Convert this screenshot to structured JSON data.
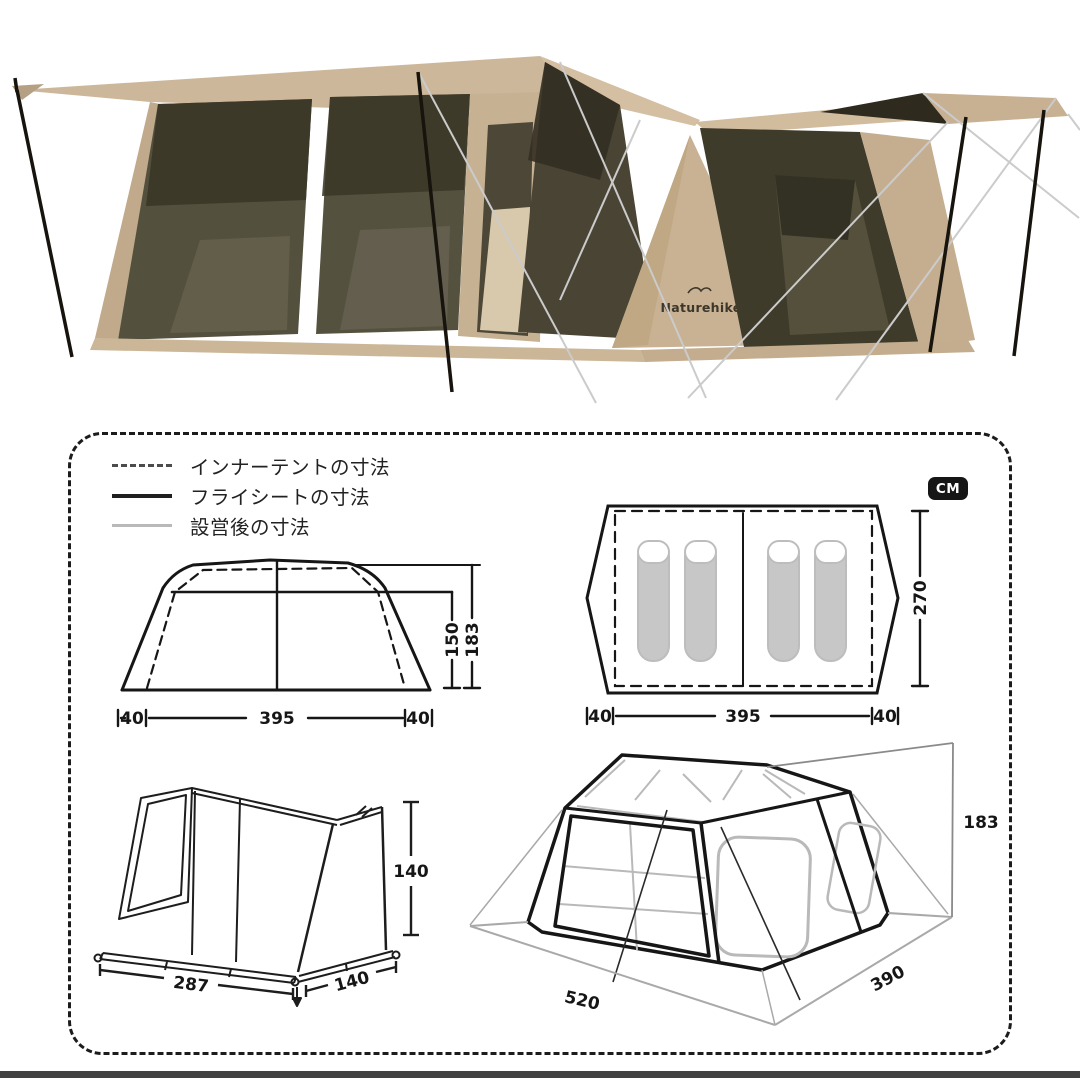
{
  "photo": {
    "brand_logo": "Naturehike",
    "colors": {
      "canvas_tan": "#cdb79b",
      "canvas_dark": "#b6a084",
      "mesh_dark": "#3a3627",
      "mesh_smoke": "#53503e",
      "olive_panel": "#3f3b2b",
      "pole_black": "#17130d",
      "guyline_gray": "#cbcbcb"
    }
  },
  "units_badge": "CM",
  "legend": {
    "items": [
      {
        "label": "インナーテントの寸法",
        "style": "dashed"
      },
      {
        "label": "フライシートの寸法",
        "style": "solid-dark"
      },
      {
        "label": "設営後の寸法",
        "style": "solid-gray"
      }
    ]
  },
  "diagrams": {
    "front_view": {
      "inner_height": "150",
      "outer_height": "183",
      "left_offset": "40",
      "width": "395",
      "right_offset": "40"
    },
    "top_view": {
      "depth": "270",
      "left_offset": "40",
      "width": "395",
      "right_offset": "40"
    },
    "inner_tent_3d": {
      "height": "140",
      "front_width": "287",
      "side_depth": "140"
    },
    "flysheet_3d": {
      "height": "183",
      "front_width": "520",
      "side_depth": "390"
    }
  }
}
